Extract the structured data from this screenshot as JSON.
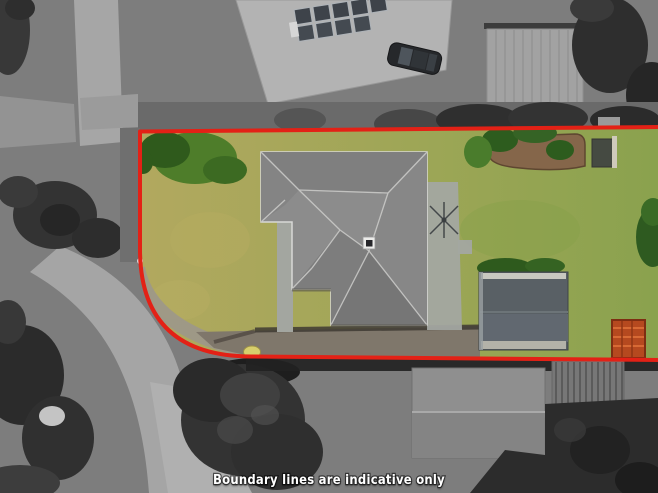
{
  "caption": {
    "text": "Boundary lines are indicative only"
  },
  "colors": {
    "boundary_line": "#e32116",
    "boundary_marker": "#d7ce6c",
    "caption_text": "#ffffff",
    "grass_left": "#b2a85f",
    "grass_mid": "#9da656",
    "grass_right": "#8aa24e",
    "house_roof": "#8c8c8c",
    "shed_roof": "#596065",
    "trampoline": "#b5491f",
    "garden_bed": "#85664a"
  },
  "scene": {
    "kind": "aerial-property-photo",
    "desaturated_surroundings": true,
    "features": [
      "street",
      "footpath",
      "neighbour-roofs",
      "solar-panels",
      "parked-car",
      "lawn",
      "main-house-roof",
      "garden-shed",
      "garden-bed",
      "trampoline",
      "clothesline",
      "trees",
      "boundary-overlay",
      "boundary-peg-marker"
    ]
  }
}
